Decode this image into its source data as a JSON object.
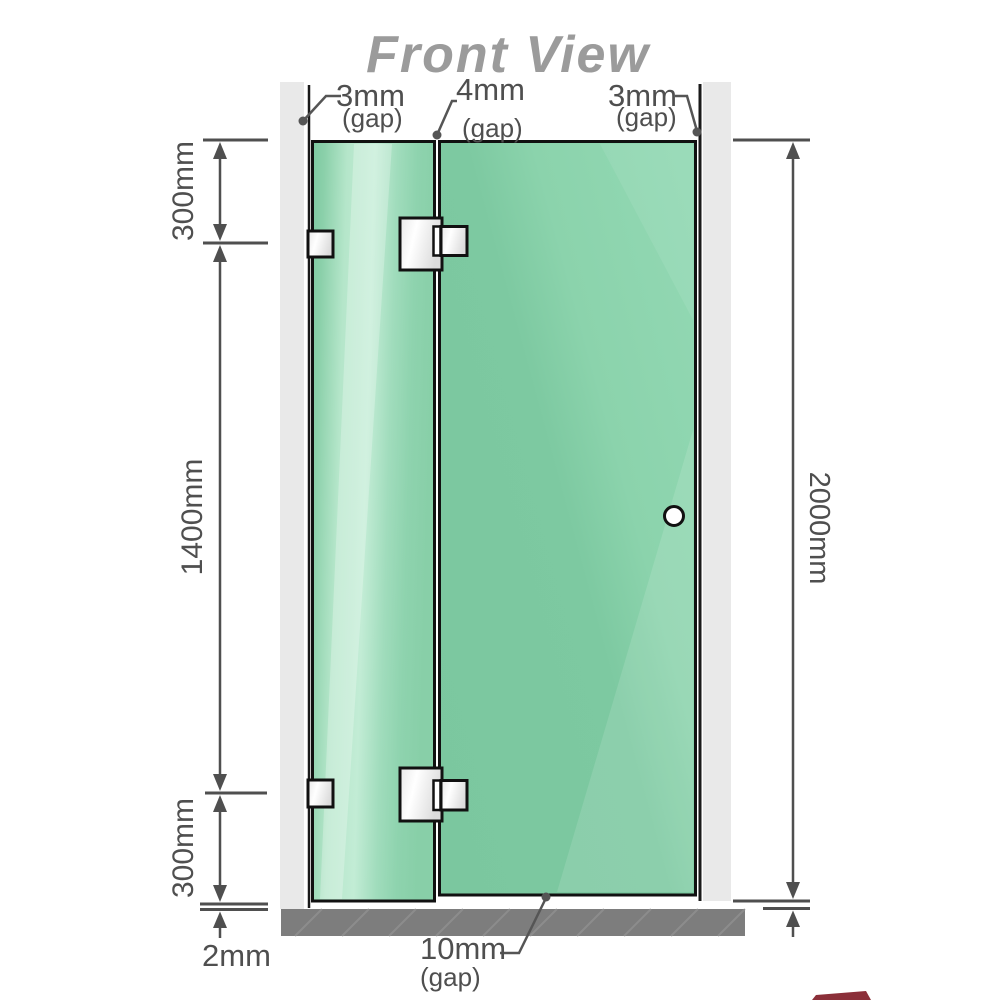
{
  "title": "Front View",
  "labels": {
    "gap_left": "3mm",
    "gap_middle": "4mm",
    "gap_right": "3mm",
    "gap_bottom": "10mm",
    "gap_word": "(gap)",
    "dim_top": "300mm",
    "dim_middle": "1400mm",
    "dim_bottom": "300mm",
    "dim_floor": "2mm",
    "dim_height": "2000mm"
  },
  "colors": {
    "title": "#9b9b9b",
    "line": "#4f4f4f",
    "outline": "#111111",
    "wall_profile": "#e9e9e9",
    "floor": "#7d7d7d",
    "glass_base": "#7dc9a1",
    "glass_mid": "#8bd3ac",
    "glass_light": "#c2ecd5",
    "glass_dark": "#88cfa8",
    "hardware_light": "#ffffff",
    "hardware_dark": "#dcdcdc",
    "logo_red": "#7e1824"
  }
}
